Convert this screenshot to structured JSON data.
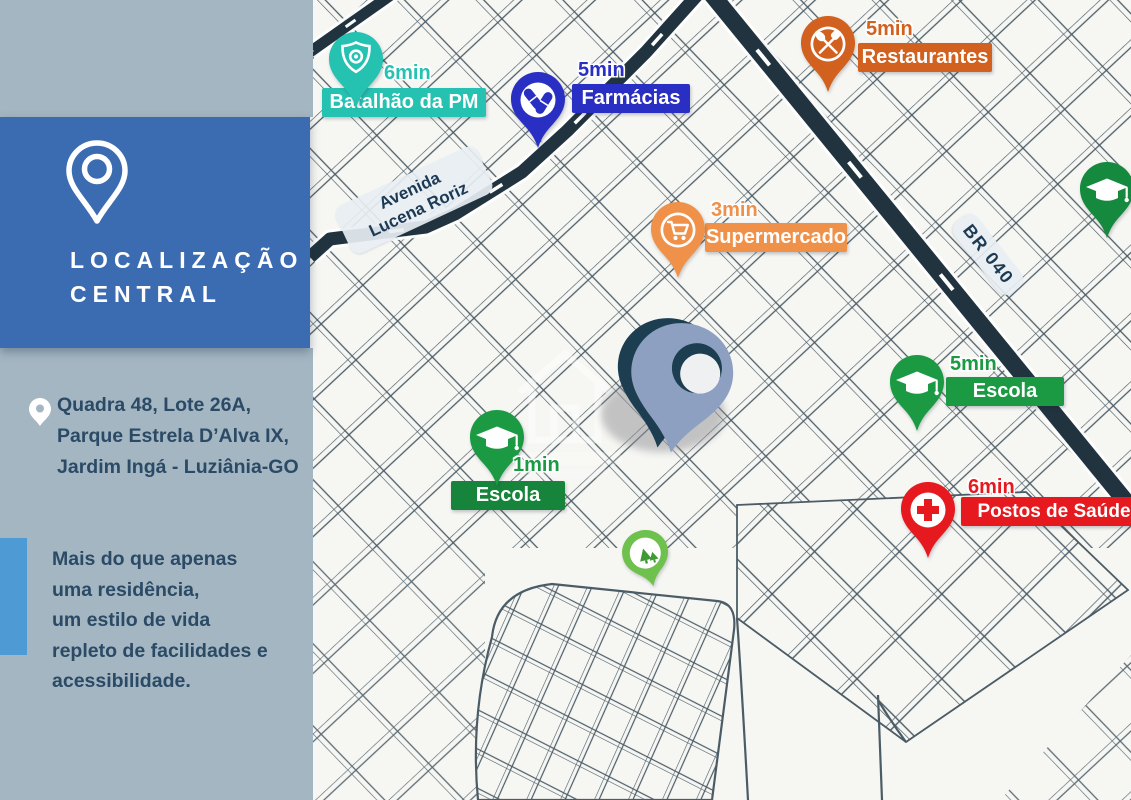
{
  "sidebar": {
    "title": {
      "line1": "LOCALIZAÇÃO",
      "line2": "CENTRAL"
    },
    "address": {
      "line1": "Quadra 48, Lote 26A,",
      "line2": "Parque Estrela D’Alva IX,",
      "line3": "Jardim Ingá - Luziânia-GO"
    },
    "tagline": {
      "line1": "Mais do que apenas",
      "line2": "uma residência,",
      "line3_prefix": "um ",
      "line3_bold": "estilo de vida",
      "line4": "repleto de facilidades e",
      "line5": "acessibilidade."
    },
    "colors": {
      "panel": "#3b6bb1",
      "background": "#a4b6c2",
      "accent_bar": "#4d9ad5",
      "text": "#2b4a66"
    }
  },
  "map": {
    "background": "#f6f6f3",
    "street_line_color": "#4b5c66",
    "highway_color": "#20333e",
    "street_labels": {
      "avenida": {
        "line1": "Avenida",
        "line2": "Lucena Roriz"
      },
      "br040": {
        "text": "BR 040"
      }
    },
    "markers": [
      {
        "time": "6min",
        "label": "Batalhão da PM",
        "color": "#25c2b2",
        "icon": "police-badge-icon"
      },
      {
        "time": "5min",
        "label": "Farmácias",
        "color": "#2a2fc4",
        "icon": "pills-icon"
      },
      {
        "time": "5min",
        "label": "Restaurantes",
        "color": "#d2601e",
        "icon": "utensils-icon"
      },
      {
        "time": "3min",
        "label": "Supermercado",
        "color": "#f0914a",
        "icon": "shopping-cart-icon"
      },
      {
        "time": "5min",
        "label": "Escola",
        "color": "#1b9a43",
        "icon": "graduation-cap-icon"
      },
      {
        "time": "1min",
        "label": "Escola",
        "color": "#1b9a43",
        "banner_color": "#16843a",
        "icon": "graduation-cap-icon"
      },
      {
        "time": "6min",
        "label": "Postos de Saúde",
        "color": "#e6191f",
        "icon": "medical-cross-icon"
      }
    ],
    "unlabeled_markers": [
      {
        "icon": "park-tree-icon",
        "color": "#6fc14d",
        "icon_color": "#3f9a35"
      },
      {
        "icon": "graduation-cap-icon",
        "color": "#15893e"
      }
    ],
    "property_pin": {
      "face_color": "#8da0c2",
      "edge_color": "#1d3e51",
      "hole_color": "#eef0f1"
    }
  }
}
